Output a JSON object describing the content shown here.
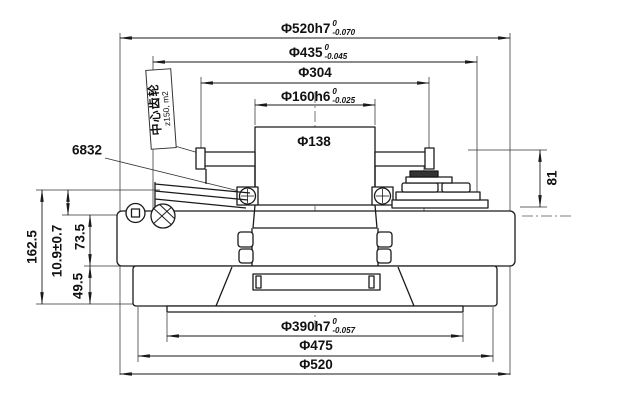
{
  "drawing": {
    "dims": {
      "phi520h7": {
        "label": "Φ520h7",
        "tol_upper": "0",
        "tol_lower": "-0.070"
      },
      "phi435": {
        "label": "Φ435",
        "tol_upper": "0",
        "tol_lower": "-0.045"
      },
      "phi304": {
        "label": "Φ304"
      },
      "phi160h6": {
        "label": "Φ160h6",
        "tol_upper": "0",
        "tol_lower": "-0.025"
      },
      "phi138": {
        "label": "Φ138"
      },
      "height81": {
        "label": "81"
      },
      "height162_5": {
        "label": "162.5"
      },
      "height10_9": {
        "label": "10.9±0.7"
      },
      "height73_5": {
        "label": "73.5"
      },
      "height49_5": {
        "label": "49.5"
      },
      "phi390h7": {
        "label": "Φ390h7",
        "tol_upper": "0",
        "tol_lower": "-0.057"
      },
      "phi475": {
        "label": "Φ475"
      },
      "phi520": {
        "label": "Φ520"
      }
    },
    "annotations": {
      "bearing_code": "6832",
      "gear_name": "中心齿轮",
      "gear_spec": "z150, m2"
    },
    "colors": {
      "line": "#1a1a1a",
      "background": "#ffffff"
    }
  }
}
